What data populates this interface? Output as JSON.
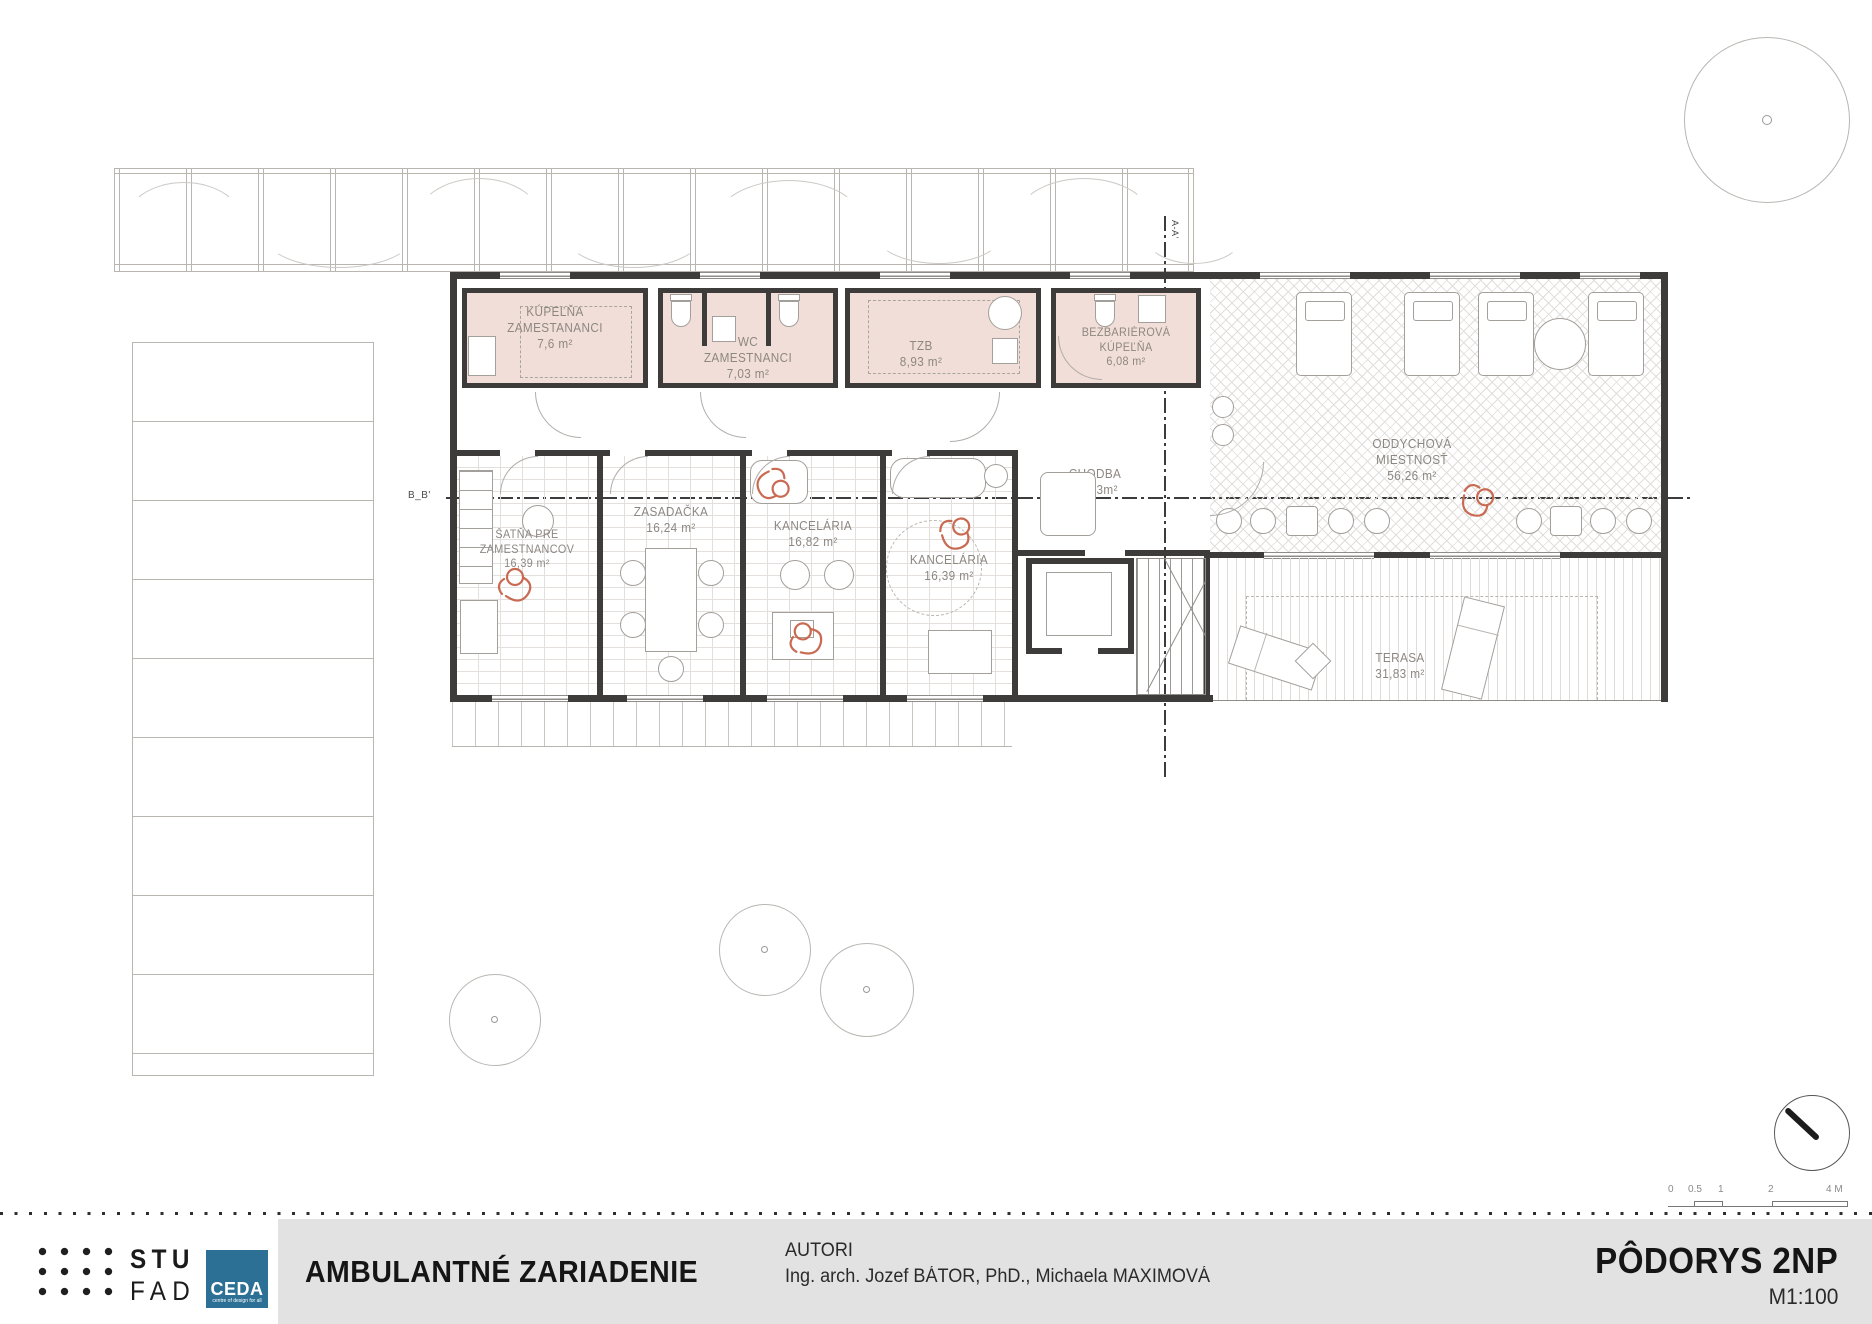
{
  "drawing": {
    "rooms": {
      "kupelna": {
        "name": "KÚPEĽŇA\nZAMESTANANCI",
        "area": "7,6 m²"
      },
      "wc": {
        "name": "WC\nZAMESTNANCI",
        "area": "7,03 m²"
      },
      "tzb": {
        "name": "TZB",
        "area": "8,93 m²"
      },
      "bezbarierova": {
        "name": "BEZBARIÉROVÁ\nKÚPEĽŇA",
        "area": "6,08 m²"
      },
      "oddychova": {
        "name": "ODDYCHOVÁ\nMIESTNOSŤ",
        "area": "56,26 m²"
      },
      "chodba": {
        "name": "CHODBA",
        "area": "34,23m²"
      },
      "satna": {
        "name": "ŠATŇA PRE\nZAMESTNANCOV",
        "area": "16,39 m²"
      },
      "zasadacka": {
        "name": "ZASADAČKA",
        "area": "16,24 m²"
      },
      "kancelaria1": {
        "name": "KANCELÁRIA",
        "area": "16,82 m²"
      },
      "kancelaria2": {
        "name": "KANCELÁRIA",
        "area": "16,39 m²"
      },
      "terasa": {
        "name": "TERASA",
        "area": "31,83 m²"
      }
    },
    "sections": {
      "aa": "A-A'",
      "bb": "B_B'"
    },
    "scale_bar": {
      "t0": "0",
      "t1": "0.5",
      "t2": "1",
      "t3": "2",
      "t4": "4 M"
    }
  },
  "footer": {
    "project_title": "AMBULANTNÉ ZARIADENIE",
    "authors_label": "AUTORI",
    "authors": "Ing. arch. Jozef BÁTOR, PhD., Michaela MAXIMOVÁ",
    "drawing_title": "PÔDORYS 2NP",
    "scale": "M1:100",
    "logos": {
      "stu_line1": "STU",
      "stu_line2": "FAD",
      "ceda": "CEDA",
      "ceda_sub": "centre of design for all"
    }
  },
  "colors": {
    "room_pink": "#f2ded8",
    "wall_dark": "#3e3c3a",
    "accent_red": "#c96a52",
    "ceda_blue": "#2d7095",
    "footer_grey": "#e2e2e2"
  }
}
